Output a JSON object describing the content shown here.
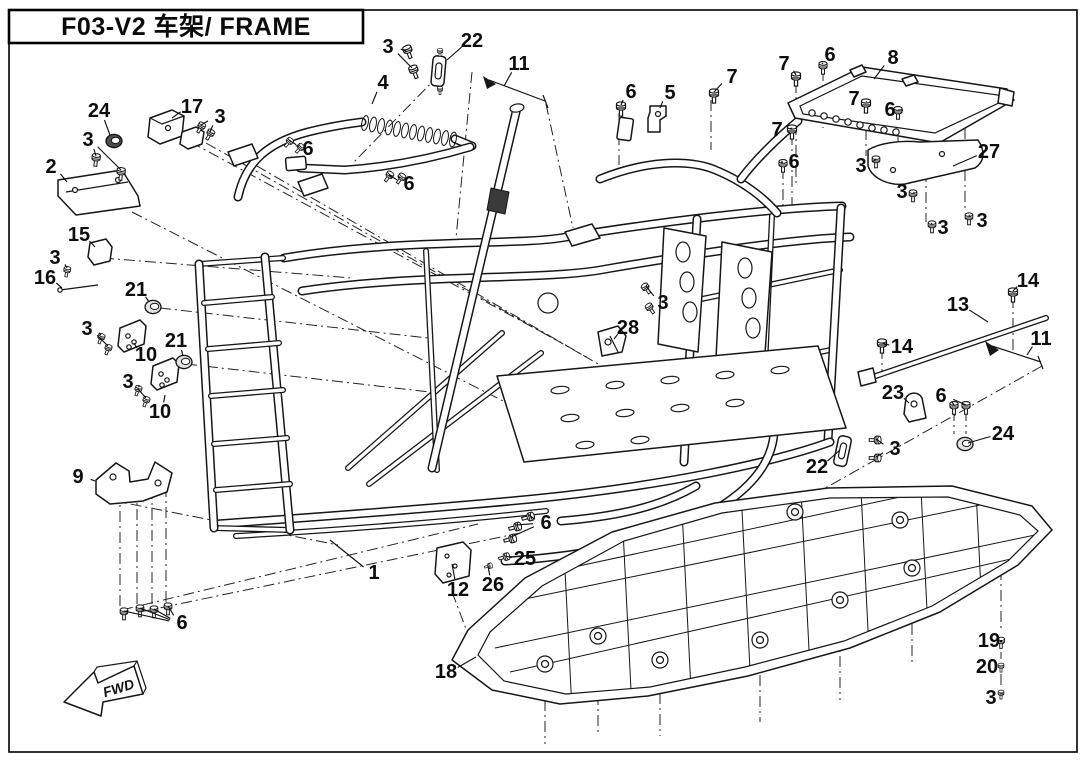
{
  "page": {
    "title": "F03-V2 车架/ FRAME",
    "fwd_label": "FWD"
  },
  "colors": {
    "ink": "#161616",
    "paper": "#ffffff"
  },
  "diagram": {
    "description": "Exploded parts-diagram of vehicle frame with numbered callouts",
    "callouts": [
      {
        "label": "24",
        "x": 99,
        "y": 111,
        "t": [
          [
            110,
            135
          ]
        ]
      },
      {
        "label": "17",
        "x": 192,
        "y": 107,
        "t": [
          [
            172,
            118
          ]
        ]
      },
      {
        "label": "3",
        "x": 220,
        "y": 117,
        "t": [
          [
            201,
            125
          ],
          [
            210,
            132
          ]
        ]
      },
      {
        "label": "3",
        "x": 88,
        "y": 140,
        "t": [
          [
            96,
            156
          ],
          [
            121,
            170
          ]
        ]
      },
      {
        "label": "2",
        "x": 51,
        "y": 167,
        "t": [
          [
            67,
            182
          ]
        ]
      },
      {
        "label": "15",
        "x": 79,
        "y": 235,
        "t": [
          [
            95,
            247
          ]
        ]
      },
      {
        "label": "3",
        "x": 55,
        "y": 258,
        "t": [
          [
            67,
            268
          ]
        ]
      },
      {
        "label": "16",
        "x": 45,
        "y": 278,
        "t": [
          [
            62,
            288
          ]
        ]
      },
      {
        "label": "21",
        "x": 136,
        "y": 290,
        "t": [
          [
            149,
            302
          ]
        ]
      },
      {
        "label": "3",
        "x": 87,
        "y": 329,
        "t": [
          [
            101,
            335
          ],
          [
            108,
            346
          ]
        ]
      },
      {
        "label": "10",
        "x": 146,
        "y": 355,
        "t": [
          [
            134,
            343
          ]
        ]
      },
      {
        "label": "21",
        "x": 176,
        "y": 341,
        "t": [
          [
            183,
            356
          ]
        ]
      },
      {
        "label": "3",
        "x": 128,
        "y": 382,
        "t": [
          [
            138,
            387
          ],
          [
            146,
            398
          ]
        ]
      },
      {
        "label": "10",
        "x": 160,
        "y": 412,
        "t": [
          [
            165,
            395
          ]
        ]
      },
      {
        "label": "9",
        "x": 78,
        "y": 477,
        "t": [
          [
            95,
            481
          ]
        ]
      },
      {
        "label": "6",
        "x": 182,
        "y": 623,
        "t": [
          [
            124,
            611
          ],
          [
            140,
            608
          ],
          [
            154,
            609
          ],
          [
            168,
            606
          ]
        ]
      },
      {
        "label": "1",
        "x": 374,
        "y": 573,
        "t": [
          [
            330,
            540
          ]
        ]
      },
      {
        "label": "3",
        "x": 388,
        "y": 47,
        "t": [
          [
            406,
            51
          ],
          [
            412,
            68
          ]
        ]
      },
      {
        "label": "22",
        "x": 472,
        "y": 41,
        "t": [
          [
            447,
            60
          ]
        ]
      },
      {
        "label": "11",
        "x": 519,
        "y": 64,
        "t": [
          [
            504,
            86
          ]
        ]
      },
      {
        "label": "4",
        "x": 383,
        "y": 83,
        "t": [
          [
            372,
            104
          ]
        ]
      },
      {
        "label": "6",
        "x": 308,
        "y": 149,
        "t": [
          [
            289,
            140
          ],
          [
            299,
            146
          ]
        ]
      },
      {
        "label": "6",
        "x": 409,
        "y": 184,
        "t": [
          [
            389,
            175
          ],
          [
            400,
            177
          ]
        ]
      },
      {
        "label": "6",
        "x": 631,
        "y": 92,
        "t": [
          [
            621,
            105
          ]
        ]
      },
      {
        "label": "5",
        "x": 670,
        "y": 93,
        "t": [
          [
            660,
            108
          ]
        ]
      },
      {
        "label": "7",
        "x": 732,
        "y": 77,
        "t": [
          [
            714,
            92
          ]
        ]
      },
      {
        "label": "7",
        "x": 784,
        "y": 64,
        "t": [
          [
            796,
            75
          ]
        ]
      },
      {
        "label": "6",
        "x": 830,
        "y": 55,
        "t": [
          [
            823,
            64
          ]
        ]
      },
      {
        "label": "8",
        "x": 893,
        "y": 58,
        "t": [
          [
            874,
            79
          ]
        ]
      },
      {
        "label": "7",
        "x": 854,
        "y": 99,
        "t": [
          [
            866,
            102
          ]
        ]
      },
      {
        "label": "6",
        "x": 890,
        "y": 110,
        "t": [
          [
            898,
            110
          ]
        ]
      },
      {
        "label": "7",
        "x": 777,
        "y": 130,
        "t": [
          [
            792,
            128
          ]
        ]
      },
      {
        "label": "6",
        "x": 794,
        "y": 162,
        "t": [
          [
            783,
            162
          ]
        ]
      },
      {
        "label": "27",
        "x": 989,
        "y": 152,
        "t": [
          [
            953,
            166
          ]
        ]
      },
      {
        "label": "3",
        "x": 861,
        "y": 166,
        "t": [
          [
            876,
            159
          ]
        ]
      },
      {
        "label": "3",
        "x": 902,
        "y": 192,
        "t": [
          [
            913,
            193
          ]
        ]
      },
      {
        "label": "3",
        "x": 943,
        "y": 228,
        "t": [
          [
            932,
            223
          ]
        ]
      },
      {
        "label": "3",
        "x": 982,
        "y": 221,
        "t": [
          [
            969,
            215
          ]
        ]
      },
      {
        "label": "14",
        "x": 1028,
        "y": 281,
        "t": [
          [
            1013,
            291
          ]
        ]
      },
      {
        "label": "13",
        "x": 958,
        "y": 305,
        "t": [
          [
            988,
            322
          ]
        ]
      },
      {
        "label": "14",
        "x": 902,
        "y": 347,
        "t": [
          [
            882,
            343
          ]
        ]
      },
      {
        "label": "11",
        "x": 1041,
        "y": 339,
        "t": [
          [
            1027,
            355
          ]
        ]
      },
      {
        "label": "3",
        "x": 663,
        "y": 303,
        "t": [
          [
            646,
            286
          ],
          [
            650,
            306
          ]
        ]
      },
      {
        "label": "28",
        "x": 628,
        "y": 328,
        "t": [
          [
            614,
            339
          ]
        ]
      },
      {
        "label": "23",
        "x": 893,
        "y": 393,
        "t": [
          [
            909,
            403
          ]
        ]
      },
      {
        "label": "6",
        "x": 941,
        "y": 396,
        "t": [
          [
            954,
            405
          ],
          [
            966,
            405
          ]
        ]
      },
      {
        "label": "24",
        "x": 1003,
        "y": 434,
        "t": [
          [
            968,
            443
          ]
        ]
      },
      {
        "label": "3",
        "x": 895,
        "y": 449,
        "t": [
          [
            876,
            439
          ],
          [
            876,
            457
          ]
        ]
      },
      {
        "label": "22",
        "x": 817,
        "y": 467,
        "t": [
          [
            840,
            450
          ]
        ]
      },
      {
        "label": "6",
        "x": 546,
        "y": 523,
        "t": [
          [
            529,
            515
          ],
          [
            516,
            525
          ],
          [
            511,
            537
          ]
        ]
      },
      {
        "label": "25",
        "x": 525,
        "y": 559,
        "t": [
          [
            505,
            556
          ]
        ]
      },
      {
        "label": "26",
        "x": 493,
        "y": 585,
        "t": [
          [
            488,
            566
          ]
        ]
      },
      {
        "label": "12",
        "x": 458,
        "y": 590,
        "t": [
          [
            452,
            564
          ]
        ]
      },
      {
        "label": "18",
        "x": 446,
        "y": 672,
        "t": [
          [
            476,
            657
          ]
        ]
      },
      {
        "label": "19",
        "x": 989,
        "y": 641,
        "t": [
          [
            1000,
            641
          ]
        ]
      },
      {
        "label": "20",
        "x": 987,
        "y": 667,
        "t": [
          [
            1000,
            666
          ]
        ]
      },
      {
        "label": "3",
        "x": 991,
        "y": 698,
        "t": [
          [
            1000,
            694
          ]
        ]
      }
    ],
    "fasteners": [
      [
        408,
        51,
        -20,
        0.9
      ],
      [
        414,
        71,
        -20,
        0.9
      ],
      [
        289,
        142,
        40,
        0.7
      ],
      [
        300,
        148,
        40,
        0.7
      ],
      [
        389,
        176,
        35,
        0.75
      ],
      [
        401,
        178,
        35,
        0.75
      ],
      [
        201,
        127,
        30,
        0.75
      ],
      [
        210,
        134,
        30,
        0.75
      ],
      [
        96,
        159,
        5,
        0.85
      ],
      [
        121,
        173,
        5,
        0.85
      ],
      [
        67,
        271,
        10,
        0.7
      ],
      [
        101,
        338,
        20,
        0.7
      ],
      [
        108,
        349,
        20,
        0.7
      ],
      [
        138,
        390,
        20,
        0.7
      ],
      [
        146,
        401,
        20,
        0.7
      ],
      [
        621,
        108,
        0,
        0.95
      ],
      [
        714,
        95,
        0,
        0.95
      ],
      [
        796,
        78,
        0,
        0.95
      ],
      [
        823,
        67,
        0,
        0.85
      ],
      [
        866,
        105,
        0,
        0.95
      ],
      [
        898,
        112,
        0,
        0.85
      ],
      [
        792,
        131,
        0,
        0.95
      ],
      [
        783,
        165,
        0,
        0.85
      ],
      [
        876,
        161,
        0,
        0.8
      ],
      [
        913,
        195,
        0,
        0.8
      ],
      [
        932,
        226,
        0,
        0.8
      ],
      [
        969,
        218,
        0,
        0.8
      ],
      [
        1013,
        294,
        0,
        0.95
      ],
      [
        882,
        345,
        0,
        0.95
      ],
      [
        954,
        407,
        0,
        0.85
      ],
      [
        966,
        407,
        0,
        0.85
      ],
      [
        876,
        440,
        90,
        0.8
      ],
      [
        876,
        458,
        90,
        0.8
      ],
      [
        529,
        517,
        75,
        0.85
      ],
      [
        516,
        527,
        75,
        0.85
      ],
      [
        511,
        539,
        75,
        0.85
      ],
      [
        505,
        557,
        75,
        0.75
      ],
      [
        489,
        566,
        75,
        0.55
      ],
      [
        124,
        613,
        0,
        0.8
      ],
      [
        140,
        610,
        0,
        0.8
      ],
      [
        154,
        611,
        0,
        0.8
      ],
      [
        168,
        608,
        0,
        0.8
      ],
      [
        1001,
        642,
        0,
        0.75
      ],
      [
        1001,
        667,
        0,
        0.6
      ],
      [
        1001,
        694,
        0,
        0.6
      ],
      [
        646,
        288,
        -35,
        0.75
      ],
      [
        650,
        308,
        -35,
        0.75
      ],
      [
        440,
        52,
        0,
        0.55
      ],
      [
        440,
        90,
        0,
        0.55
      ]
    ],
    "bushings": [
      [
        114,
        141,
        "D"
      ],
      [
        153,
        307,
        "L"
      ],
      [
        184,
        362,
        "L"
      ],
      [
        965,
        444,
        "L"
      ]
    ]
  }
}
